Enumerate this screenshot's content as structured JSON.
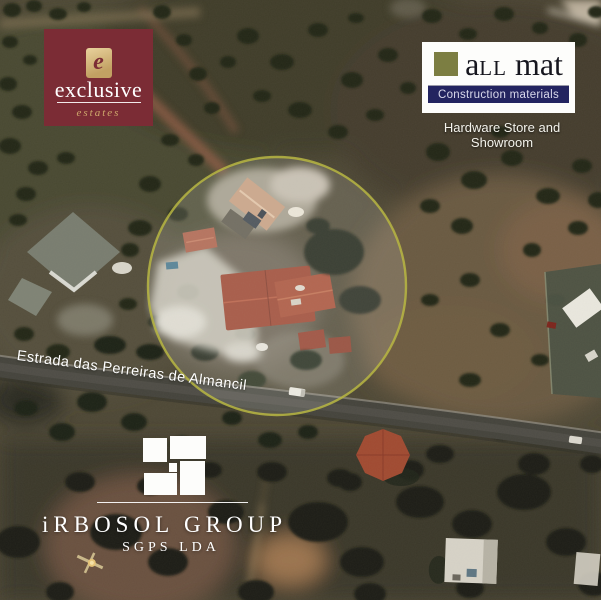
{
  "scene": {
    "type": "aerial-map",
    "road_label": "Estrada das Perreiras de Almancil",
    "highlight_circle_color": "#b9b73f"
  },
  "logos": {
    "exclusive": {
      "emblem_letter": "e",
      "name": "exclusive",
      "subname": "estates",
      "bg_color": "#7b2c35",
      "accent_color": "#cfa96c"
    },
    "all_mat": {
      "brand_a": "a",
      "brand_ll": "LL",
      "brand_mat": "mat",
      "tagline": "Construction materials",
      "subtitle": "Hardware Store and Showroom",
      "square_color": "#7c7e42",
      "bar_color": "#232460"
    },
    "irbosol": {
      "name": "iRBOSOL GROUP",
      "subname": "SGPS LDA"
    }
  }
}
